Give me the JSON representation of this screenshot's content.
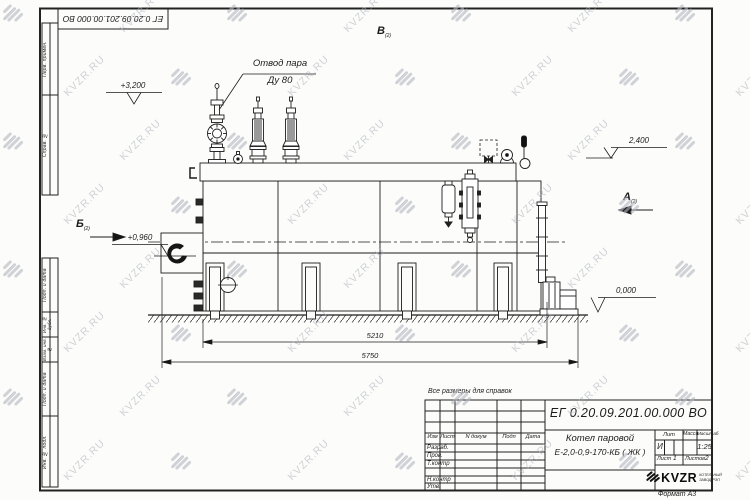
{
  "watermark": {
    "text": "KVZR.RU"
  },
  "sheet": {
    "corner_designation": "ЕГ 0.20.09.201.00.000  ВО",
    "note": "Все размеры для справок",
    "format_label": "Формат А3",
    "side_labels_top": [
      "Перв. примен.",
      "Справ. №"
    ],
    "side_labels_bottom": [
      "Подп. и дата",
      "Инв. № дубл.",
      "Взам. инв. №",
      "Подп. и дата",
      "Инв. № подл."
    ]
  },
  "title_block": {
    "designation": "ЕГ 0.20.09.201.00.000  ВО",
    "product_line1": "Котел паровой",
    "product_line2": "Е-2,0-0,9-170-КБ ( ЖК )",
    "col_izm": "Изм",
    "col_list": "Лист",
    "col_ndokum": "N докум",
    "col_podp": "Подп",
    "col_data": "Дата",
    "row_razrab": "Разраб.",
    "row_prov": "Пров.",
    "row_tkontr": "Т.контр",
    "row_nkontr": "Н.контр",
    "row_utv": "Утв.",
    "lit_label": "Лит",
    "lit_value": "И",
    "mass_label": "Масса",
    "scale_label": "Масштаб",
    "scale_value": "1:25",
    "sheet_label": "Лист",
    "sheet_value": "1",
    "sheets_label": "Листов",
    "sheets_value": "2",
    "logo_text": "KVZR",
    "logo_sub1": "КОТЕЛЬНЫЙ",
    "logo_sub2": "ЗАВОД РЭП"
  },
  "drawing": {
    "callout_line1": "Отвод пара",
    "callout_line2": "Ду 80",
    "elev_top_left": "+3,200",
    "elev_top_right": "2,400",
    "elev_mid_left": "+0,960",
    "elev_ground": "0,000",
    "dim_inner": "5210",
    "dim_outer": "5750",
    "view_top": "В",
    "view_right": "А",
    "view_left": "Б",
    "view_sheet_ref": "(2)"
  }
}
